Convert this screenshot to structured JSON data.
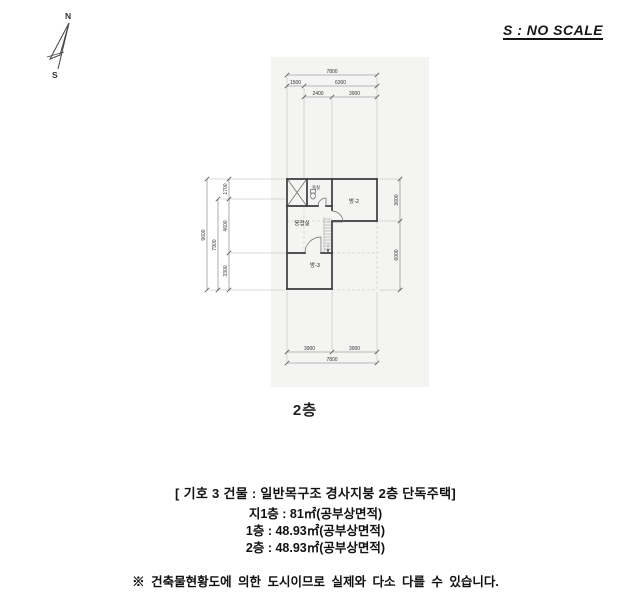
{
  "compass": {
    "north_label": "N",
    "south_label": "S"
  },
  "scale_note": "S : NO SCALE",
  "floor_label": "2층",
  "plan": {
    "rooms": [
      {
        "name": "욕실"
      },
      {
        "name": "방-2"
      },
      {
        "name": "응접실"
      },
      {
        "name": "방-3"
      }
    ],
    "dimensions": {
      "top": [
        "7800",
        "1500",
        "6300",
        "2400",
        "3900"
      ],
      "bottom": [
        "3900",
        "3900",
        "7800"
      ],
      "left": [
        "9600",
        "7900",
        "1700",
        "4600",
        "3300"
      ],
      "right": [
        "3600",
        "6000"
      ]
    }
  },
  "notes": {
    "building_title": "[ 기호 3 건물 : 일반목구조 경사지붕 2층 단독주택]",
    "areas": [
      "지1층 : 81㎡(공부상면적)",
      "1층 : 48.93㎡(공부상면적)",
      "2층 : 48.93㎡(공부상면적)"
    ],
    "disclaimer": "※ 건축물현황도에 의한 도시이므로 실제와 다소 다를 수 있습니다."
  }
}
